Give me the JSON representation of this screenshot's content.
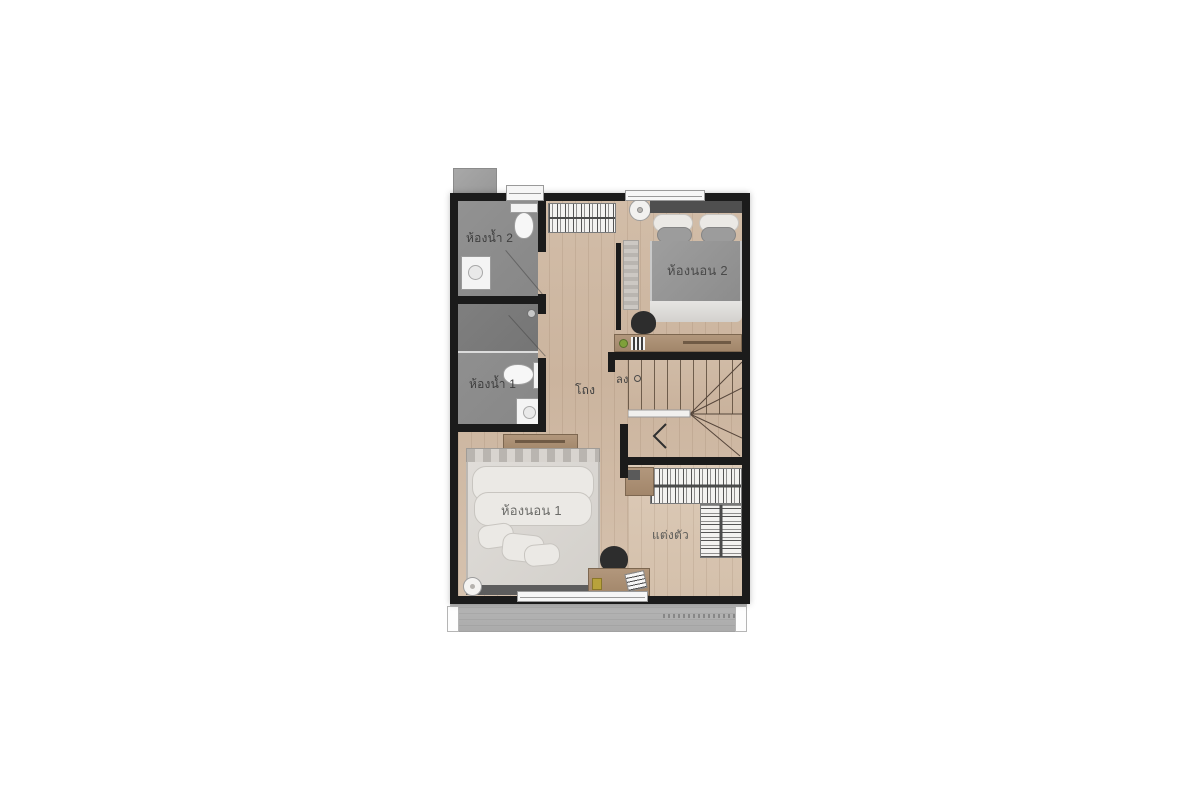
{
  "rooms": {
    "bathroom2": {
      "label": "ห้องน้ำ 2"
    },
    "bathroom1": {
      "label": "ห้องน้ำ 1"
    },
    "bedroom2": {
      "label": "ห้องนอน 2"
    },
    "bedroom1": {
      "label": "ห้องนอน 1"
    },
    "hall": {
      "label": "โถง"
    },
    "dressing": {
      "label": "แต่งตัว"
    },
    "stairs": {
      "label": "ลง"
    }
  },
  "colors": {
    "wall": "#1b1b1b",
    "text": "#3e3e3e",
    "bathroom_floor": "#8e8e8e",
    "wood_floor": "#cdb7a2",
    "furniture_wood": "#ab8f74",
    "duvet_gray": "#949494",
    "duvet_light": "#dcdad6",
    "balcony_gray": "#b2b2b2",
    "window_white": "#f6f6f6"
  }
}
